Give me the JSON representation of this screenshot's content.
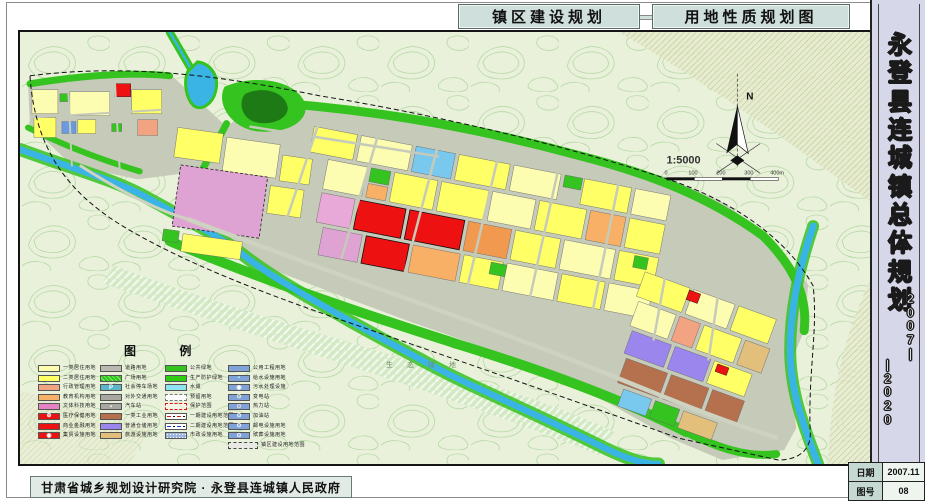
{
  "header": {
    "title_left": "镇区建设规划",
    "title_right": "用地性质规划图"
  },
  "sidebar": {
    "title": "永登县连城镇总体规划",
    "years_top": "2007|",
    "years_bottom": "|2020",
    "info": [
      {
        "label": "日期",
        "value": "2007.11"
      },
      {
        "label": "图号",
        "value": "08"
      }
    ]
  },
  "footer": {
    "credit": "甘肃省城乡规划设计研究院 · 永登县连城镇人民政府"
  },
  "map": {
    "north_label": "N",
    "scale_text": "1:5000",
    "scale_ticks": [
      "0",
      "100",
      "200",
      "300",
      "400m"
    ],
    "eco_label": "生 态 绿 地"
  },
  "legend": {
    "title": "图 例",
    "columns": [
      [
        {
          "label": "一类居住用地",
          "fill": "#fdfdb2"
        },
        {
          "label": "二类居住用地",
          "fill": "#ffff66"
        },
        {
          "label": "行政管理用地",
          "fill": "#f2a482"
        },
        {
          "label": "教育机构用地",
          "fill": "#f7b066"
        },
        {
          "label": "文体科技用地",
          "fill": "#e383c4"
        },
        {
          "label": "医疗保健用地",
          "fill": "#ee1111",
          "glyph": "⊕",
          "glyphColor": "#ffffff"
        },
        {
          "label": "商业金融用地",
          "fill": "#ee1111"
        },
        {
          "label": "集贸设施用地",
          "fill": "#ee1111",
          "glyph": "◉",
          "glyphColor": "#ffffff"
        }
      ],
      [
        {
          "label": "道路用地",
          "fill": "#b9b9b0"
        },
        {
          "label": "广场用地",
          "pattern": "plaza"
        },
        {
          "label": "社会停车场地",
          "fill": "#59b7c9",
          "glyph": "P",
          "glyphColor": "#ffffff"
        },
        {
          "label": "对外交通用地",
          "fill": "#a8a8a0"
        },
        {
          "label": "汽车站",
          "fill": "#a8a8a0",
          "glyph": "▪",
          "glyphColor": "#ffffff"
        },
        {
          "label": "一类工业用地",
          "fill": "#b5714e"
        },
        {
          "label": "普通仓储用地",
          "fill": "#9b86ee"
        },
        {
          "label": "旅游设施用地",
          "fill": "#e3bf7c"
        }
      ],
      [
        {
          "label": "公共绿地",
          "fill": "#35c320"
        },
        {
          "label": "生产防护绿地",
          "fill": "#2ecc12"
        },
        {
          "label": "水域",
          "fill": "#8fe5ef"
        },
        {
          "label": "预留用地",
          "pattern": "dashed-white"
        },
        {
          "label": "保护范围",
          "pattern": "dashed-red"
        },
        {
          "label": "一期建设用地范围",
          "pattern": "line-red"
        },
        {
          "label": "二期建设用地范围",
          "pattern": "line-blue"
        },
        {
          "label": "市政设施用地",
          "pattern": "blue-grid"
        }
      ],
      [
        {
          "label": "公用工程用地",
          "fill": "#7fa3d9"
        },
        {
          "label": "给水设施用地",
          "fill": "#7fa3d9",
          "glyph": "▪",
          "glyphColor": "#aaffff"
        },
        {
          "label": "污水处理设施",
          "fill": "#7fa3d9",
          "glyph": "◉",
          "glyphColor": "#ffffff"
        },
        {
          "label": "变电站",
          "fill": "#7fa3d9",
          "glyph": "⊙",
          "glyphColor": "#ffffcc"
        },
        {
          "label": "热力站",
          "fill": "#7fa3d9",
          "glyph": "⊙",
          "glyphColor": "#ffdddd"
        },
        {
          "label": "加油站",
          "fill": "#7fa3d9",
          "glyph": "⊙",
          "glyphColor": "#ffffff"
        },
        {
          "label": "邮电设施用地",
          "fill": "#7fa3d9",
          "glyph": "⊙",
          "glyphColor": "#ffffff"
        },
        {
          "label": "殡葬设施用地",
          "fill": "#7fa3d9",
          "glyph": "⊙",
          "glyphColor": "#ffffff"
        },
        {
          "label": "镇区建设用地范围",
          "pattern": "wide-dash",
          "wide": true
        }
      ]
    ]
  },
  "palette": {
    "residential_1": "#fdfdb2",
    "residential_2": "#ffff66",
    "admin": "#f2a482",
    "education": "#f7b066",
    "culture": "#e383c4",
    "commercial": "#ee1111",
    "industry": "#b5714e",
    "storage": "#9b86ee",
    "tourism": "#e3bf7c",
    "road": "#c6cab9",
    "green": "#35c320",
    "park_dark": "#1e7a14",
    "water": "#3ab4e4",
    "terrain": "#e9f1da",
    "contour": "#9ccb8a",
    "sidebar_bg": "#d6d8e9",
    "header_bg": "#cfdfdb"
  }
}
